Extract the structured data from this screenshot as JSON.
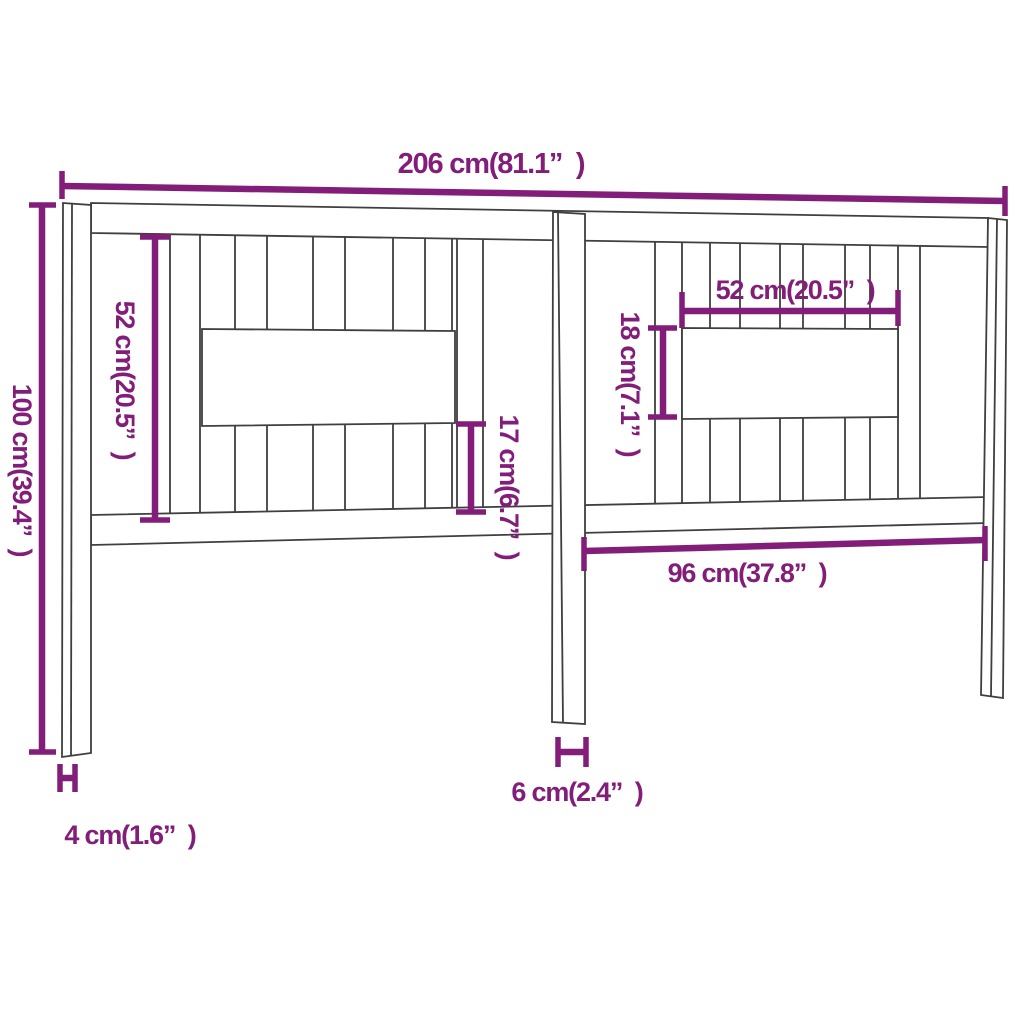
{
  "page": {
    "kind": "furniture dimension diagram",
    "subject": "bed headboard with vertical slats, two horizontal boards and three posts",
    "background": "#ffffff"
  },
  "colors": {
    "dimension_accent": "#821e79",
    "drawing_outline": "#3f3f3f"
  },
  "labels": {
    "total_width": "206 cm(81.1”  )",
    "total_height": "100 cm(39.4”  )",
    "left_panel_height": "52 cm(20.5”  )",
    "right_board_width": "52 cm(20.5”  )",
    "right_board_height": "18 cm(7.1”  )",
    "lower_gap_height": "17 cm(6.7”  )",
    "right_section_width": "96 cm(37.8”  )",
    "center_post_width": "6 cm(2.4”  )",
    "side_post_depth": "4 cm(1.6”  )"
  },
  "measurements": [
    {
      "id": "total_width",
      "cm": 206,
      "inches": 81.1,
      "orientation": "horizontal",
      "location": "top, full span"
    },
    {
      "id": "total_height",
      "cm": 100,
      "inches": 39.4,
      "orientation": "vertical",
      "location": "left, full height"
    },
    {
      "id": "left_panel_height",
      "cm": 52,
      "inches": 20.5,
      "orientation": "vertical",
      "location": "left half, slat area height"
    },
    {
      "id": "right_board_width",
      "cm": 52,
      "inches": 20.5,
      "orientation": "horizontal",
      "location": "right half, center board width"
    },
    {
      "id": "right_board_height",
      "cm": 18,
      "inches": 7.1,
      "orientation": "vertical",
      "location": "right half, center board height"
    },
    {
      "id": "lower_gap_height",
      "cm": 17,
      "inches": 6.7,
      "orientation": "vertical",
      "location": "center, board bottom to bottom rail"
    },
    {
      "id": "right_section_width",
      "cm": 96,
      "inches": 37.8,
      "orientation": "horizontal",
      "location": "center post to right post"
    },
    {
      "id": "center_post_width",
      "cm": 6,
      "inches": 2.4,
      "orientation": "horizontal",
      "location": "under center post"
    },
    {
      "id": "side_post_depth",
      "cm": 4,
      "inches": 1.6,
      "orientation": "horizontal",
      "location": "under left post"
    }
  ]
}
